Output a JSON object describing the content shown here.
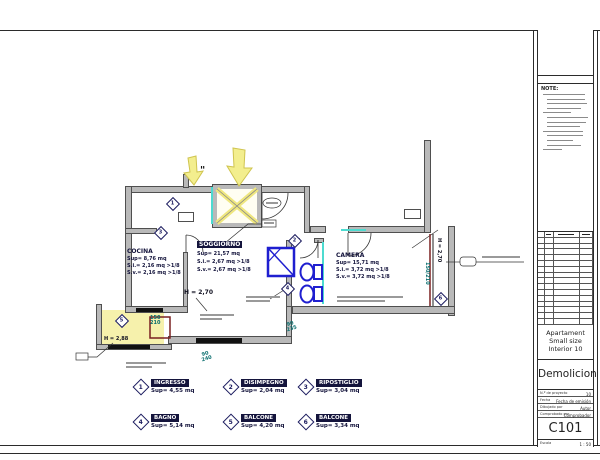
{
  "colors": {
    "wall": "#b9b9b9",
    "highlight_yellow": "#f3ee8e",
    "new_work_blue": "#1f1fd0",
    "dimension_teal": "#0a6e6e",
    "demolition_maroon": "#7a2020",
    "accent_cyan": "#4ddbd0",
    "label_navy": "#14143c"
  },
  "titleblock": {
    "note_label": "NOTE:",
    "project_name_lines": [
      "Apartament",
      "Small size",
      "Interior 10"
    ],
    "sheet_name": "Demolicion",
    "fields": [
      {
        "label": "N.º de proyecto",
        "value": "10"
      },
      {
        "label": "Fecha",
        "value": "Fecha de emisión"
      },
      {
        "label": "Dibujado por",
        "value": "Autor"
      },
      {
        "label": "Comprobado por",
        "value": "Comprobador"
      }
    ],
    "sheet_number": "C101",
    "scale_label": "Escala",
    "scale_value": "1 : 50"
  },
  "plan": {
    "rooms": {
      "cocina": {
        "name": "COCINA",
        "sup": "Sup= 8,76 mq",
        "si": "S.i.= 2,16 mq >1/8",
        "sv": "S.v.= 2,16 mq >1/8"
      },
      "soggiorno": {
        "name": "SOGGIORNO",
        "sup": "Sup= 21,57 mq",
        "si": "S.i.= 2,67 mq >1/8",
        "sv": "S.v.= 2,67 mq >1/8"
      },
      "camera": {
        "name": "CAMERA",
        "sup": "Sup= 15,71 mq",
        "si": "S.i.= 3,72 mq >1/8",
        "sv": "S.v.= 3,72 mq >1/8"
      }
    },
    "heights": {
      "center": "H = 2,70",
      "left": "H = 2,88",
      "right": "H = 2,70"
    },
    "dims": {
      "d1": {
        "top": "150",
        "bot": "210"
      },
      "d2": {
        "top": "90",
        "bot": "240"
      },
      "d3": {
        "top": "90",
        "bot": "235"
      },
      "d4": "150/210"
    },
    "badges": [
      "1",
      "2",
      "3",
      "4",
      "5",
      "6"
    ],
    "quote_mark": "\""
  },
  "legend": {
    "items": [
      {
        "num": "1",
        "label": "INGRESSO",
        "sup": "Sup= 4,55 mq"
      },
      {
        "num": "2",
        "label": "DISIMPEGNO",
        "sup": "Sup= 2,04 mq"
      },
      {
        "num": "3",
        "label": "RIPOSTIGLIO",
        "sup": "Sup= 3,04 mq"
      },
      {
        "num": "4",
        "label": "BAGNO",
        "sup": "Sup= 5,14 mq"
      },
      {
        "num": "5",
        "label": "BALCONE",
        "sup": "Sup= 4,20 mq"
      },
      {
        "num": "6",
        "label": "BALCONE",
        "sup": "Sup= 3,34 mq"
      }
    ]
  }
}
